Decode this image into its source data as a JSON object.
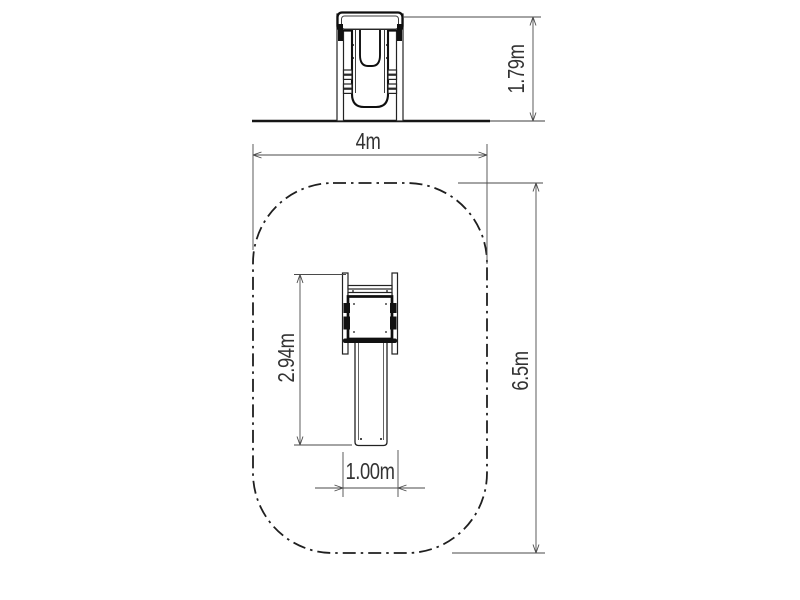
{
  "drawing": {
    "title": "playground slide installation drawing",
    "colors": {
      "background": "#ffffff",
      "ink": "#111111",
      "dimension_lines": "#4a4a4a",
      "dimension_text": "#333333",
      "safety_zone_line": "#1f1f1f"
    },
    "elevation_view": {
      "description": "front elevation of slide on ground line",
      "height_label": "1.79m"
    },
    "plan_view": {
      "description": "top view with dash-dot safety zone boundary",
      "zone_width_label": "4m",
      "zone_length_label": "6.5m",
      "equipment_length_label": "2.94m",
      "equipment_width_label": "1.00m",
      "safety_zone_style": "dash-dot rounded rectangle"
    }
  }
}
